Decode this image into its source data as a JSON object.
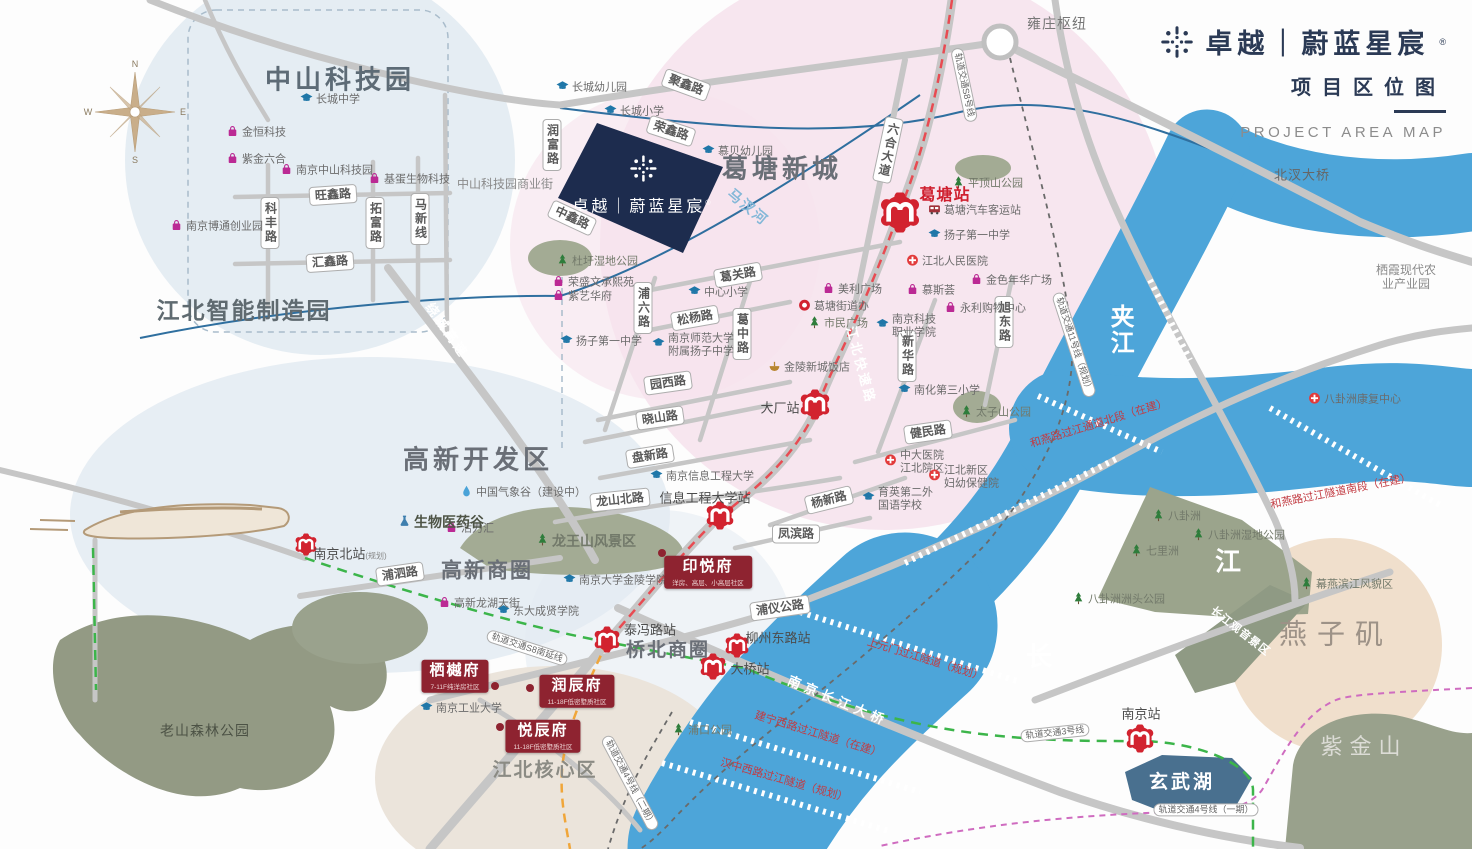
{
  "header": {
    "brand": "卓越｜蔚蓝星宸",
    "reg": "®",
    "subtitle_cn": "项目区位图",
    "subtitle_en": "PROJECT AREA MAP"
  },
  "compass": {
    "n": "N",
    "e": "E",
    "s": "S",
    "w": "W"
  },
  "parcel": {
    "name": "卓越｜蔚蓝星宸",
    "reg": "®"
  },
  "colors": {
    "navy": "#1d2c4e",
    "brand_navy": "#2b3a55",
    "metro_red": "#d2232f",
    "project_red": "#8e2330",
    "river": "#4da5d9",
    "pink_zone": "#f6e2ec",
    "blue_zone": "#dfe8f0",
    "road": "#c6c6c6",
    "s8_line": "#e84b52",
    "line3_green": "#3cb54a",
    "line4_magenta": "#cf6cc0",
    "s8_south_orange": "#f0a63a"
  },
  "area_labels": [
    {
      "t": "中山科技园",
      "x": 340,
      "y": 80,
      "s": 26,
      "c": "#5d6b76",
      "ls": 4,
      "b": 1
    },
    {
      "t": "江北智能制造园",
      "x": 244,
      "y": 311,
      "s": 23,
      "c": "#5f6a70",
      "ls": 2,
      "b": 1
    },
    {
      "t": "葛塘新城",
      "x": 782,
      "y": 169,
      "s": 26,
      "c": "#6a6f77",
      "ls": 4,
      "b": 1
    },
    {
      "t": "高新开发区",
      "x": 478,
      "y": 460,
      "s": 26,
      "c": "#6a6f77",
      "ls": 4,
      "b": 1
    },
    {
      "t": "高新商圈",
      "x": 487,
      "y": 572,
      "s": 21,
      "c": "#6a6f77",
      "ls": 2,
      "b": 1
    },
    {
      "t": "桥北商圈",
      "x": 668,
      "y": 651,
      "s": 19,
      "c": "#6a6f77",
      "ls": 2,
      "b": 1
    },
    {
      "t": "江北核心区",
      "x": 545,
      "y": 771,
      "s": 19,
      "c": "#8b8b84",
      "ls": 2,
      "b": 1
    },
    {
      "t": "燕子矶",
      "x": 1336,
      "y": 634,
      "s": 28,
      "c": "#9d9287",
      "ls": 10,
      "b": 0
    },
    {
      "t": "紫金山",
      "x": 1364,
      "y": 747,
      "s": 22,
      "c": "#dcdcd6",
      "ls": 7,
      "b": 0
    },
    {
      "t": "老山森林公园",
      "x": 205,
      "y": 731,
      "s": 14,
      "c": "#4c5245",
      "ls": 1,
      "b": 0
    },
    {
      "t": "雍庄枢纽",
      "x": 1057,
      "y": 24,
      "s": 14,
      "c": "#777777",
      "ls": 1,
      "b": 0
    },
    {
      "t": "北汊大桥",
      "x": 1302,
      "y": 175,
      "s": 13,
      "c": "#666666",
      "ls": 1,
      "b": 0
    },
    {
      "t": "栖霞现代农业产业园",
      "x": 1406,
      "y": 277,
      "s": 12,
      "c": "#8a8a8a",
      "ls": 0,
      "b": 0
    },
    {
      "t": "中山科技园商业街",
      "x": 505,
      "y": 184,
      "s": 12,
      "c": "#8a8a8a",
      "ls": 0,
      "b": 0
    }
  ],
  "water_labels": [
    {
      "t": "夹江",
      "x": 1119,
      "y": 330,
      "s": 24,
      "v": 1
    },
    {
      "t": "长",
      "x": 1040,
      "y": 657,
      "s": 26
    },
    {
      "t": "江",
      "x": 1229,
      "y": 562,
      "s": 26
    },
    {
      "t": "玄武湖",
      "x": 1182,
      "y": 783,
      "s": 19,
      "ls": 3
    },
    {
      "t": "马汊河",
      "x": 748,
      "y": 207,
      "s": 14,
      "r": 40,
      "c": "#85b8d8"
    },
    {
      "t": "南京长江大桥",
      "x": 838,
      "y": 701,
      "s": 13,
      "r": 23,
      "ls": 5
    },
    {
      "t": "长江观音景区",
      "x": 1240,
      "y": 632,
      "s": 11,
      "r": 38,
      "ls": 1
    }
  ],
  "tunnel_labels": [
    {
      "t": "上元门过江隧道（规划）",
      "x": 925,
      "y": 660,
      "r": 17
    },
    {
      "t": "建宁西路过江隧道（在建）",
      "x": 818,
      "y": 735,
      "r": 17
    },
    {
      "t": "汉中西路过江隧道（规划）",
      "x": 784,
      "y": 781,
      "r": 16
    },
    {
      "t": "和燕路过江通道北段（在建）",
      "x": 1099,
      "y": 424,
      "r": -17
    },
    {
      "t": "和燕路过江隧道南段（在建）",
      "x": 1341,
      "y": 492,
      "r": -11
    }
  ],
  "rail_labels": [
    {
      "t": "轨道交通S8号线",
      "x": 964,
      "y": 85,
      "r": 78
    },
    {
      "t": "轨道交通S8南延线",
      "x": 527,
      "y": 648,
      "r": 18
    },
    {
      "t": "轨道交通11号线（规划）",
      "x": 1074,
      "y": 345,
      "r": 72
    },
    {
      "t": "轨道交通4号线（二期）",
      "x": 630,
      "y": 783,
      "r": 62
    },
    {
      "t": "轨道交通3号线",
      "x": 1055,
      "y": 733,
      "r": -6
    },
    {
      "t": "轨道交通4号线（一期）",
      "x": 1206,
      "y": 810,
      "r": 0
    }
  ],
  "onroad_labels": [
    {
      "t": "江北快速路",
      "x": 862,
      "y": 365,
      "r": 75
    },
    {
      "t": "绕城高速",
      "x": 448,
      "y": 330,
      "r": 55
    }
  ],
  "road_labels": [
    {
      "t": "聚鑫路",
      "x": 686,
      "y": 85,
      "r": 20
    },
    {
      "t": "荣鑫路",
      "x": 671,
      "y": 131,
      "r": 18
    },
    {
      "t": "润富路",
      "x": 552,
      "y": 145,
      "v": 1
    },
    {
      "t": "中鑫路",
      "x": 572,
      "y": 218,
      "r": 25
    },
    {
      "t": "葛关路",
      "x": 738,
      "y": 275,
      "r": -10
    },
    {
      "t": "浦六路",
      "x": 643,
      "y": 308,
      "v": 1
    },
    {
      "t": "松杨路",
      "x": 695,
      "y": 318,
      "r": -10
    },
    {
      "t": "葛中路",
      "x": 742,
      "y": 334,
      "v": 1
    },
    {
      "t": "园西路",
      "x": 668,
      "y": 383,
      "r": -8
    },
    {
      "t": "晓山路",
      "x": 660,
      "y": 418,
      "r": -8
    },
    {
      "t": "盘新路",
      "x": 650,
      "y": 456,
      "r": -9
    },
    {
      "t": "龙山北路",
      "x": 620,
      "y": 500,
      "r": -6
    },
    {
      "t": "凤滨路",
      "x": 796,
      "y": 534,
      "r": 0
    },
    {
      "t": "杨新路",
      "x": 829,
      "y": 500,
      "r": -14
    },
    {
      "t": "新华路",
      "x": 907,
      "y": 356,
      "v": 1
    },
    {
      "t": "旭东路",
      "x": 1004,
      "y": 322,
      "v": 1
    },
    {
      "t": "健民路",
      "x": 928,
      "y": 432,
      "r": -8
    },
    {
      "t": "六合大道",
      "x": 888,
      "y": 150,
      "v": 1,
      "r": 12
    },
    {
      "t": "科丰路",
      "x": 270,
      "y": 223,
      "v": 1
    },
    {
      "t": "旺鑫路",
      "x": 333,
      "y": 195,
      "r": -4
    },
    {
      "t": "拓富路",
      "x": 375,
      "y": 223,
      "v": 1
    },
    {
      "t": "马新线",
      "x": 420,
      "y": 219,
      "v": 1
    },
    {
      "t": "汇鑫路",
      "x": 330,
      "y": 262,
      "r": -4
    },
    {
      "t": "浦泗路",
      "x": 400,
      "y": 574,
      "r": -8
    },
    {
      "t": "浦仪公路",
      "x": 780,
      "y": 608,
      "r": -8
    }
  ],
  "stations": [
    {
      "t": "葛塘站",
      "lx": 945,
      "ly": 193,
      "x": 900,
      "y": 215,
      "sz": 40,
      "red": 1
    },
    {
      "t": "大厂站",
      "lx": 780,
      "ly": 407,
      "x": 815,
      "y": 407,
      "sz": 30
    },
    {
      "t": "信息工程大学站",
      "lx": 705,
      "ly": 497,
      "x": 720,
      "y": 518,
      "sz": 28
    },
    {
      "t": "南京北站",
      "suffix": "(规划)",
      "lx": 350,
      "ly": 553,
      "x": 306,
      "y": 547,
      "sz": 22
    },
    {
      "t": "泰冯路站",
      "lx": 650,
      "ly": 629,
      "x": 607,
      "y": 642,
      "sz": 26
    },
    {
      "t": "柳州东路站",
      "lx": 778,
      "ly": 637,
      "x": 737,
      "y": 648,
      "sz": 24
    },
    {
      "t": "大桥站",
      "lx": 750,
      "ly": 668,
      "x": 713,
      "y": 669,
      "sz": 26
    },
    {
      "t": "南京站",
      "lx": 1141,
      "ly": 713,
      "x": 1140,
      "y": 741,
      "sz": 28
    }
  ],
  "pois": [
    {
      "k": "school",
      "t": "长城中学",
      "x": 300,
      "y": 100
    },
    {
      "k": "school",
      "t": "长城幼儿园",
      "x": 556,
      "y": 88
    },
    {
      "k": "school",
      "t": "长城小学",
      "x": 604,
      "y": 112
    },
    {
      "k": "school",
      "t": "慕贝幼儿园",
      "x": 702,
      "y": 152
    },
    {
      "k": "school",
      "t": "中心小学",
      "x": 688,
      "y": 293
    },
    {
      "k": "school",
      "t": "扬子第一中学",
      "x": 560,
      "y": 342
    },
    {
      "k": "school",
      "t": "南京师范大学\n附属扬子中学",
      "x": 652,
      "y": 345
    },
    {
      "k": "school",
      "t": "扬子第一中学",
      "x": 928,
      "y": 236
    },
    {
      "k": "school",
      "t": "南京科技\n职业学院",
      "x": 876,
      "y": 326
    },
    {
      "k": "school",
      "t": "南化第三小学",
      "x": 898,
      "y": 391
    },
    {
      "k": "school",
      "t": "育英第二外\n国语学校",
      "x": 862,
      "y": 499
    },
    {
      "k": "school",
      "t": "南京信息工程大学",
      "x": 650,
      "y": 477
    },
    {
      "k": "school",
      "t": "南京大学金陵学院",
      "x": 563,
      "y": 581
    },
    {
      "k": "school",
      "t": "东大成贤学院",
      "x": 497,
      "y": 612
    },
    {
      "k": "school",
      "t": "南京工业大学",
      "x": 420,
      "y": 709
    },
    {
      "k": "hospital",
      "t": "江北人民医院",
      "x": 906,
      "y": 262
    },
    {
      "k": "hospital",
      "t": "中大医院\n江北院区",
      "x": 884,
      "y": 462
    },
    {
      "k": "hospital",
      "t": "江北新区\n妇幼保健院",
      "x": 928,
      "y": 477
    },
    {
      "k": "hospital",
      "t": "八卦洲康复中心",
      "x": 1308,
      "y": 400
    },
    {
      "k": "shop",
      "t": "金恒科技",
      "x": 226,
      "y": 133
    },
    {
      "k": "shop",
      "t": "紫金六合",
      "x": 226,
      "y": 160
    },
    {
      "k": "shop",
      "t": "南京中山科技园",
      "x": 280,
      "y": 171
    },
    {
      "k": "shop",
      "t": "基蛋生物科技",
      "x": 368,
      "y": 180
    },
    {
      "k": "shop",
      "t": "南京博通创业园",
      "x": 170,
      "y": 227
    },
    {
      "k": "shop",
      "t": "美利广场",
      "x": 822,
      "y": 290
    },
    {
      "k": "gov",
      "t": "葛塘街道办",
      "x": 798,
      "y": 307
    },
    {
      "k": "shop",
      "t": "慕斯荟",
      "x": 906,
      "y": 291
    },
    {
      "k": "shop",
      "t": "永利购物中心",
      "x": 944,
      "y": 309
    },
    {
      "k": "shop",
      "t": "金色年华广场",
      "x": 970,
      "y": 281
    },
    {
      "k": "park",
      "t": "市民广场",
      "x": 808,
      "y": 324
    },
    {
      "k": "hotel",
      "t": "金陵新城饭店",
      "x": 768,
      "y": 368
    },
    {
      "k": "shop",
      "t": "高新龙湖天街",
      "x": 438,
      "y": 604
    },
    {
      "k": "shop",
      "t": "活力汇",
      "x": 445,
      "y": 529
    },
    {
      "k": "shop",
      "t": "荣盛文承熙苑",
      "x": 552,
      "y": 283
    },
    {
      "k": "shop",
      "t": "紫艺华府",
      "x": 552,
      "y": 297
    },
    {
      "k": "weather",
      "t": "中国气象谷（建设中）",
      "x": 460,
      "y": 493
    },
    {
      "k": "bio",
      "t": "生物医药谷",
      "x": 398,
      "y": 522,
      "em": 1
    },
    {
      "k": "park",
      "t": "杜圩湿地公园",
      "x": 556,
      "y": 262
    },
    {
      "k": "park",
      "t": "平顶山公园",
      "x": 952,
      "y": 184
    },
    {
      "k": "park",
      "t": "太子山公园",
      "x": 960,
      "y": 413
    },
    {
      "k": "park",
      "t": "浦口公园",
      "x": 672,
      "y": 731
    },
    {
      "k": "park",
      "t": "龙王山风景区",
      "x": 536,
      "y": 541,
      "em": 1
    },
    {
      "k": "park",
      "t": "八卦洲",
      "x": 1152,
      "y": 517
    },
    {
      "k": "park",
      "t": "七里洲",
      "x": 1130,
      "y": 552
    },
    {
      "k": "park",
      "t": "八卦洲湿地公园",
      "x": 1192,
      "y": 536
    },
    {
      "k": "park",
      "t": "八卦洲洲头公园",
      "x": 1072,
      "y": 600
    },
    {
      "k": "park",
      "t": "幕燕滨江风貌区",
      "x": 1300,
      "y": 585
    },
    {
      "k": "bus",
      "t": "葛塘汽车客运站",
      "x": 928,
      "y": 211
    }
  ],
  "projects": [
    {
      "t": "印悦府",
      "sub": "洋房、高层、小高层社区",
      "x": 708,
      "y": 572,
      "dx": 662,
      "dy": 553
    },
    {
      "t": "栖樾府",
      "sub": "7-11F纯洋房社区",
      "x": 455,
      "y": 676,
      "dx": 495,
      "dy": 686
    },
    {
      "t": "润辰府",
      "sub": "11-18F低密墅质社区",
      "x": 577,
      "y": 691,
      "dx": 530,
      "dy": 688
    },
    {
      "t": "悦辰府",
      "sub": "11-18F低密墅质社区",
      "x": 543,
      "y": 736,
      "dx": 500,
      "dy": 727
    }
  ]
}
